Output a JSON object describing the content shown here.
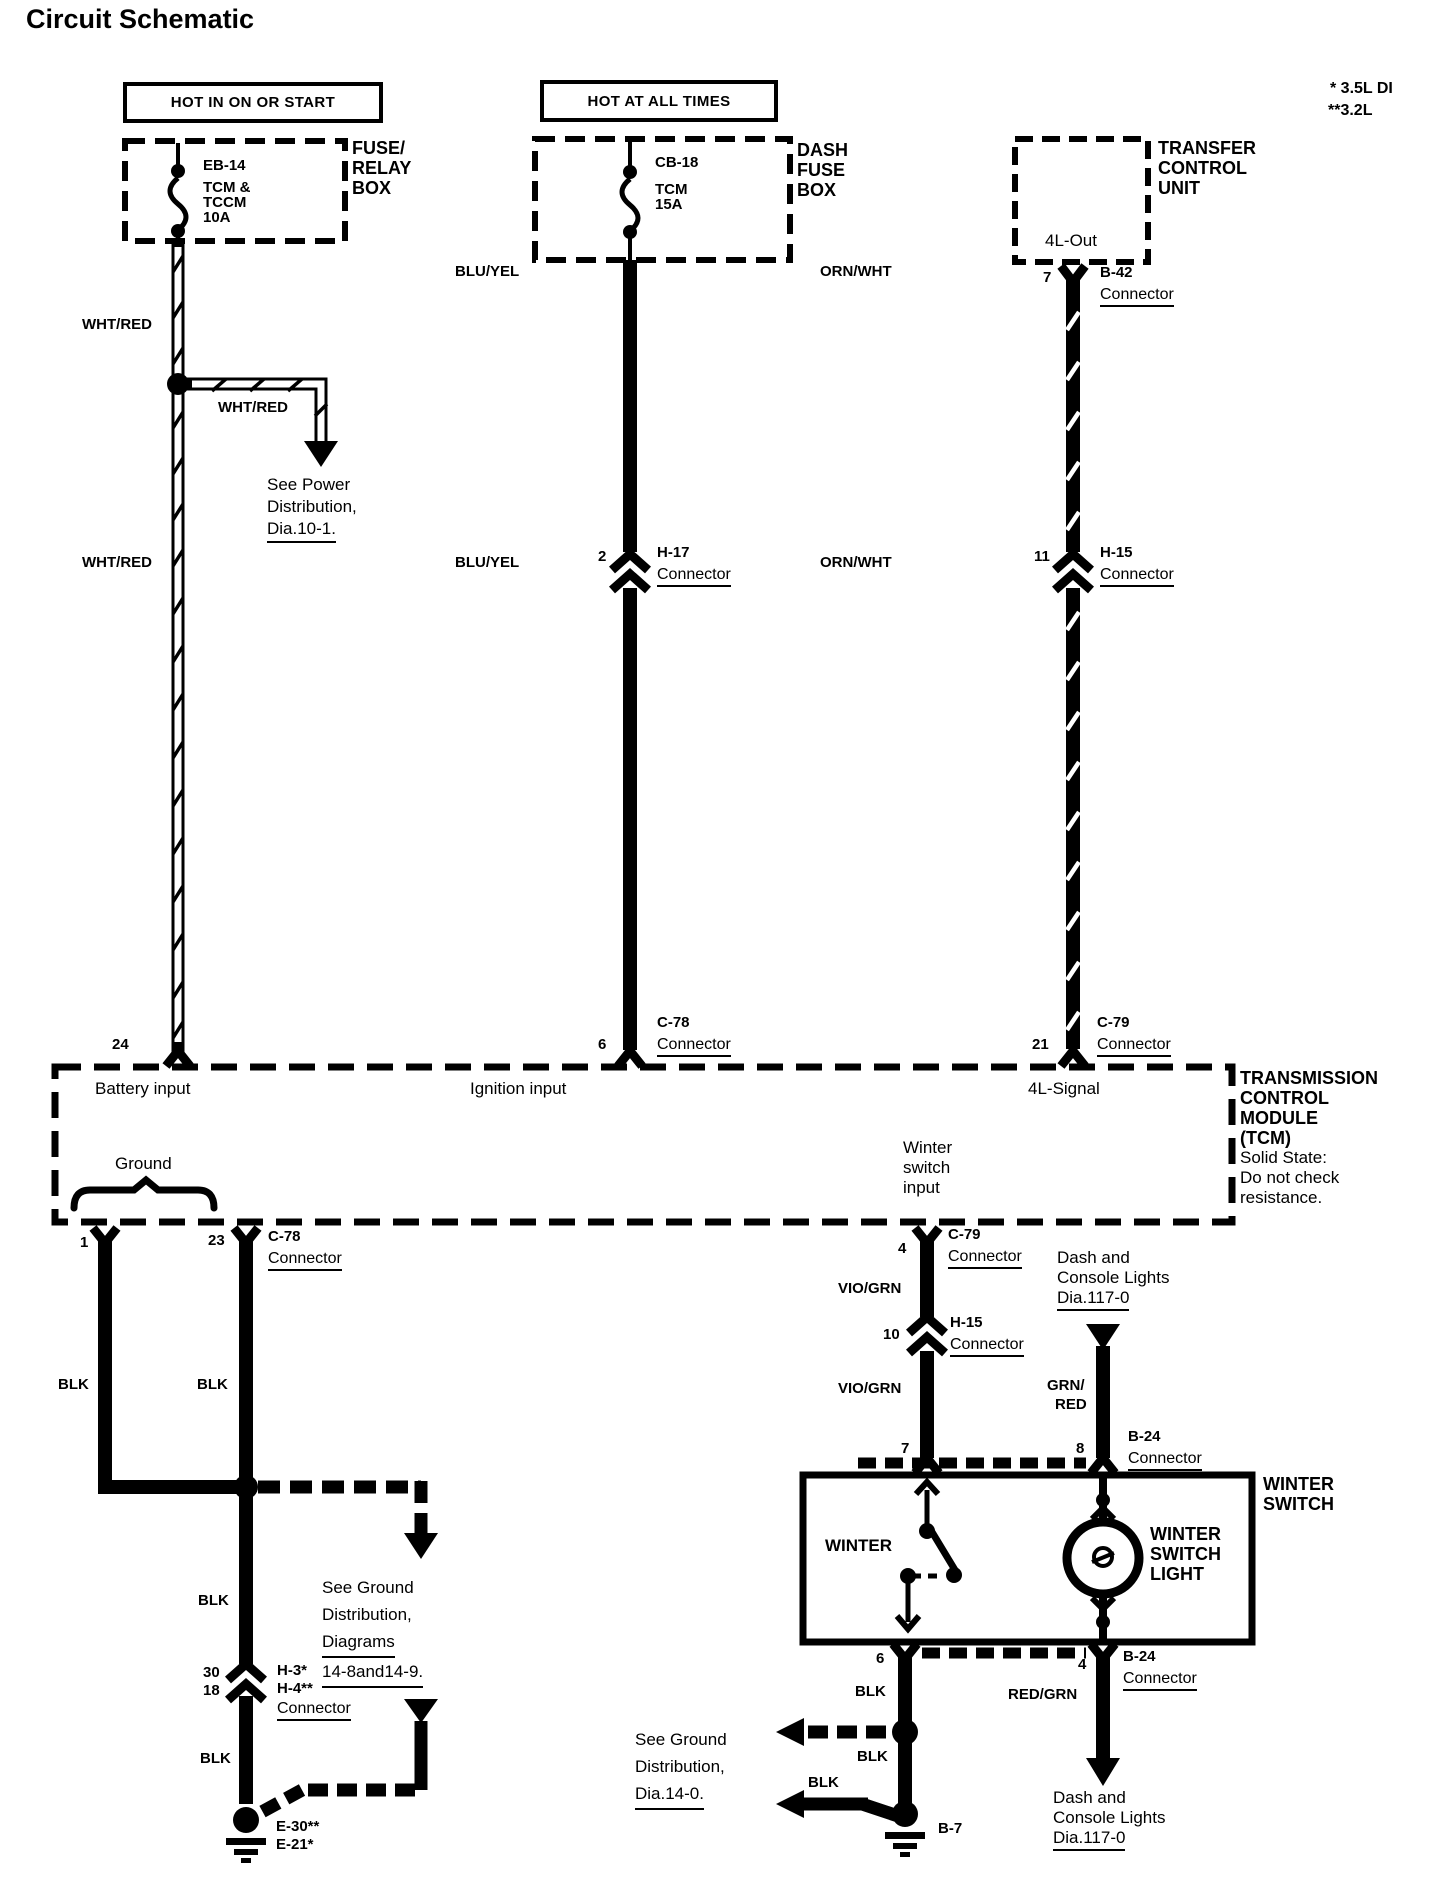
{
  "title": "Circuit Schematic",
  "engine_notes": {
    "note1": "* 3.5L DI",
    "note2": "**3.2L"
  },
  "left_circuit": {
    "banner": "HOT IN ON OR START",
    "box_name": {
      "l1": "FUSE/",
      "l2": "RELAY",
      "l3": "BOX"
    },
    "fuse": {
      "id": "EB-14",
      "name1": "TCM &",
      "name2": "TCCM",
      "rating": "10A"
    },
    "wire_color_top": "WHT/RED",
    "branch_color": "WHT/RED",
    "branch_ref": {
      "l1": "See Power",
      "l2": "Distribution,",
      "l3": "Dia.10-1."
    },
    "wire_color_bottom": "WHT/RED",
    "pin_tcm": "24"
  },
  "middle_circuit": {
    "banner": "HOT AT ALL TIMES",
    "box_name": {
      "l1": "DASH",
      "l2": "FUSE",
      "l3": "BOX"
    },
    "fuse": {
      "id": "CB-18",
      "name": "TCM",
      "rating": "15A"
    },
    "wire_color_top": "BLU/YEL",
    "mid_connector": {
      "pin": "2",
      "id": "H-17",
      "word": "Connector"
    },
    "wire_color_bottom": "BLU/YEL",
    "tcm_connector": {
      "pin": "6",
      "id": "C-78",
      "word": "Connector"
    }
  },
  "right_circuit": {
    "box_name": {
      "l1": "TRANSFER",
      "l2": "CONTROL",
      "l3": "UNIT"
    },
    "output_label": "4L-Out",
    "top_connector": {
      "pin": "7",
      "id": "B-42",
      "word": "Connector"
    },
    "wire_color_top": "ORN/WHT",
    "mid_connector": {
      "pin": "11",
      "id": "H-15",
      "word": "Connector"
    },
    "wire_color_bottom": "ORN/WHT",
    "tcm_connector": {
      "pin": "21",
      "id": "C-79",
      "word": "Connector"
    }
  },
  "tcm": {
    "battery_input": "Battery input",
    "ignition_input": "Ignition input",
    "signal_4l": "4L-Signal",
    "winter_input": {
      "l1": "Winter",
      "l2": "switch",
      "l3": "input"
    },
    "ground": "Ground",
    "name": {
      "l1": "TRANSMISSION",
      "l2": "CONTROL",
      "l3": "MODULE",
      "l4": "(TCM)"
    },
    "note": {
      "l1": "Solid State:",
      "l2": "Do not check",
      "l3": "resistance."
    }
  },
  "ground_circuit": {
    "pin_a": "1",
    "pin_b": "23",
    "connector": {
      "id": "C-78",
      "word": "Connector"
    },
    "color_a": "BLK",
    "color_b": "BLK",
    "ref": {
      "l1": "See Ground",
      "l2": "Distribution,",
      "l3": "Diagrams",
      "l4": "14-8and14-9."
    },
    "color_mid": "BLK",
    "mid_connector": {
      "pin_a": "30",
      "pin_b": "18",
      "id_a": "H-3*",
      "id_b": "H-4**",
      "word": "Connector"
    },
    "color_bottom": "BLK",
    "ground_point": {
      "id_a": "E-30**",
      "id_b": "E-21*"
    }
  },
  "winter_circuit": {
    "tcm_connector": {
      "pin": "4",
      "id": "C-79",
      "word": "Connector"
    },
    "wire_color_top": "VIO/GRN",
    "mid_connector": {
      "pin": "10",
      "id": "H-15",
      "word": "Connector"
    },
    "wire_color_bottom": "VIO/GRN",
    "switch_in_pin": "7",
    "lights_ref_top": {
      "l1": "Dash and",
      "l2": "Console Lights",
      "l3": "Dia.117-0"
    },
    "lamp_wire": {
      "l1": "GRN/",
      "l2": "RED"
    },
    "lamp_connector": {
      "pin": "8",
      "id": "B-24",
      "word": "Connector"
    },
    "box_name": {
      "l1": "WINTER",
      "l2": "SWITCH"
    },
    "switch_label": "WINTER",
    "lamp_label": {
      "l1": "WINTER",
      "l2": "SWITCH",
      "l3": "LIGHT"
    },
    "switch_out_pin": "6",
    "out_color_a": "BLK",
    "out_color_b": "BLK",
    "branch_color": "BLK",
    "ground_ref": {
      "l1": "See Ground",
      "l2": "Distribution,",
      "l3": "Dia.14-0."
    },
    "ground_id": "B-7",
    "lamp_out_connector": {
      "pin": "4",
      "id": "B-24",
      "word": "Connector"
    },
    "lamp_out_color": "RED/GRN",
    "lights_ref_bottom": {
      "l1": "Dash and",
      "l2": "Console Lights",
      "l3": "Dia.117-0"
    }
  }
}
